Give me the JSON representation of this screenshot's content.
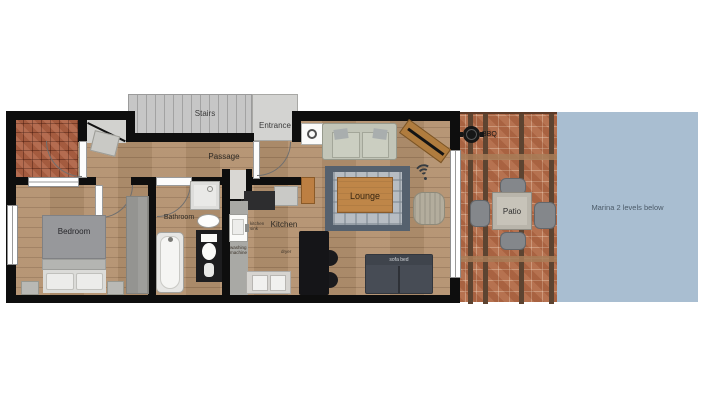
{
  "plan": {
    "rooms": {
      "stairs": "Stairs",
      "entrance": "Entrance",
      "passage": "Passage",
      "bedroom": "Bedroom",
      "bathroom": "Bathroom",
      "kitchen": "Kitchen",
      "lounge": "Lounge",
      "patio": "Patio"
    },
    "labels": {
      "bbq": "BBQ",
      "marina": "Marina 2 levels below",
      "linen_cupboard": "linen cupboard",
      "kitchen_sink": "kitchen sink",
      "washing_machine": "washing machine",
      "dryer": "dryer",
      "sofa_bed": "sofa bed"
    },
    "colors": {
      "wall": "#0e0e0e",
      "wood_floor": "#b3916f",
      "balcony_tile": "#ae6143",
      "patio_tile": "#b26a47",
      "marina_water": "#a9bed1",
      "stairs_gray": "#c6c6c6",
      "rug_border": "#55616e",
      "sofa": "#c2c5b8",
      "sofa_bed": "#474c55"
    }
  }
}
